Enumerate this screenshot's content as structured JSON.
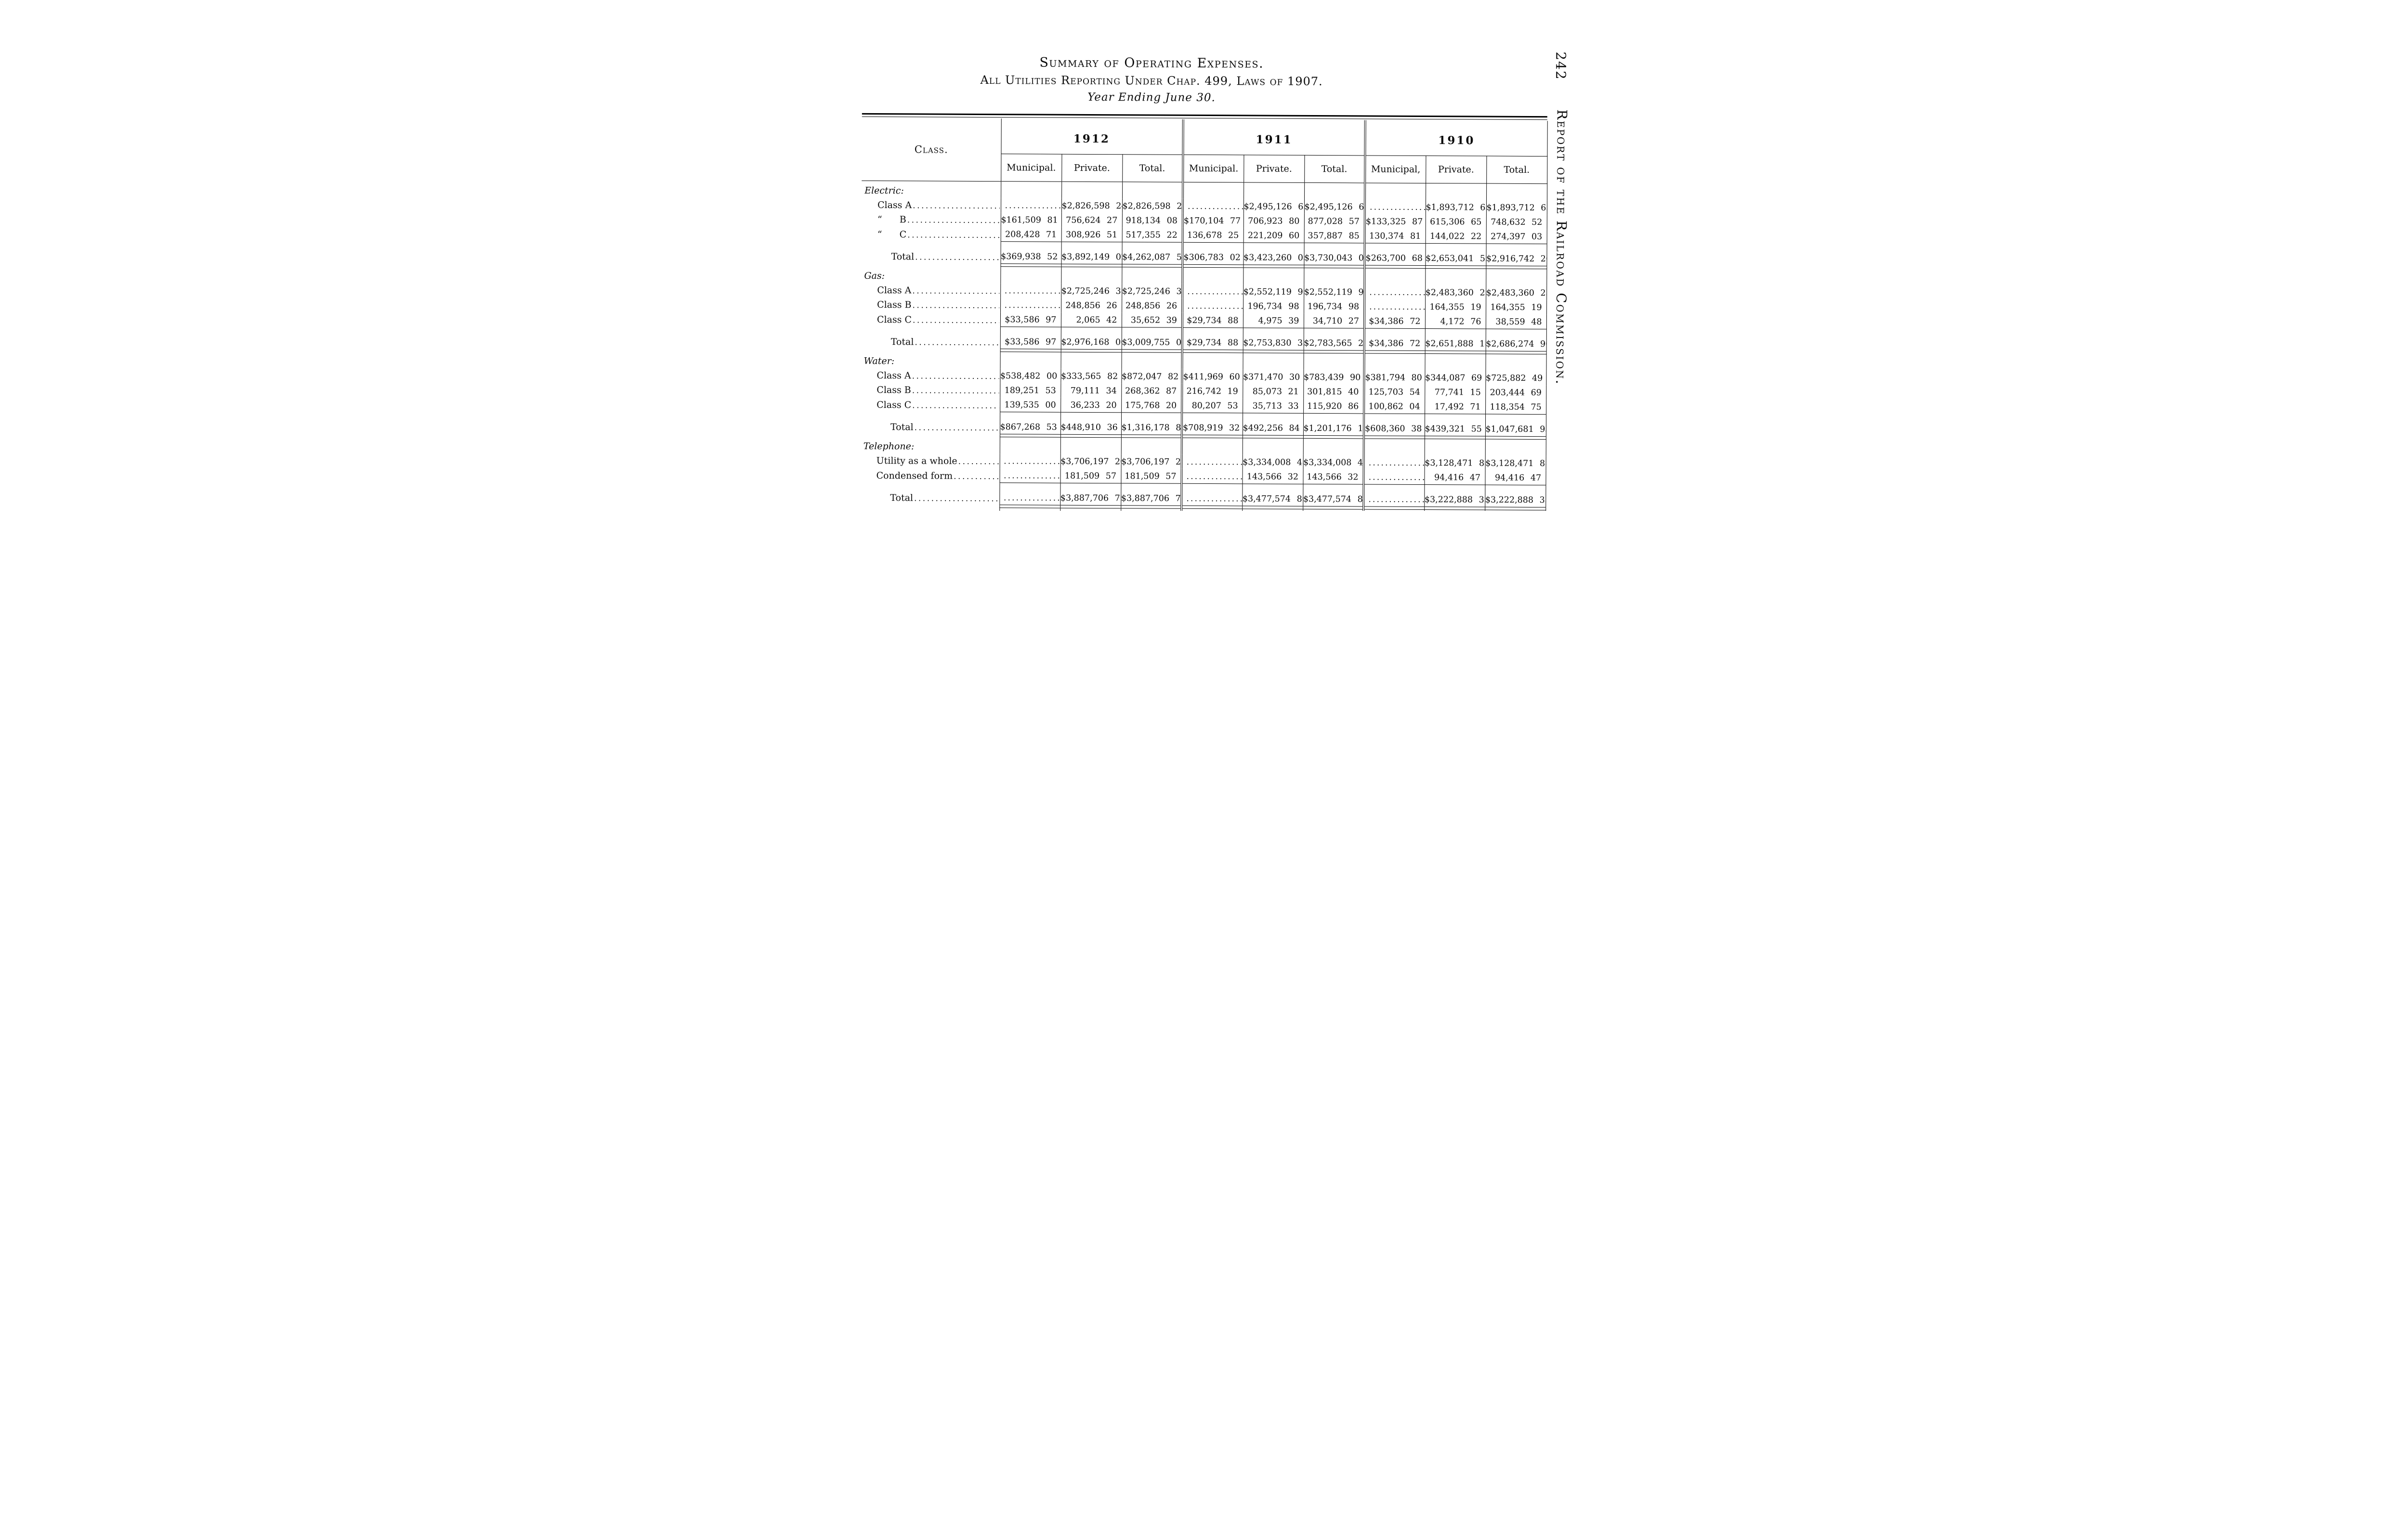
{
  "page": {
    "number": "242",
    "side_title": "Report of the Railroad Commission."
  },
  "title": {
    "line1": "Summary of Operating Expenses.",
    "line2": "All Utilities Reporting Under Chap. 499, Laws of 1907.",
    "line3": "Year Ending June 30."
  },
  "table": {
    "class_header": "Class.",
    "years": [
      {
        "label": "1912",
        "columns": [
          "Municipal.",
          "Private.",
          "Total."
        ]
      },
      {
        "label": "1911",
        "columns": [
          "Municipal.",
          "Private.",
          "Total."
        ]
      },
      {
        "label": "1910",
        "columns": [
          "Municipal,",
          "Private.",
          "Total."
        ]
      }
    ],
    "rows": [
      {
        "kind": "section",
        "em": "Electric:",
        "text": "",
        "indent": 0,
        "leader": false,
        "cells": [
          "",
          "",
          "",
          "",
          "",
          "",
          "",
          "",
          ""
        ]
      },
      {
        "kind": "item",
        "em": "",
        "text": "Class A",
        "indent": 1,
        "leader": true,
        "cells": [
          "..............",
          "$2,826,598 24",
          "$2,826,598 24",
          "..............",
          "$2,495,126 65",
          "$2,495,126 65",
          "..............",
          "$1,893,712 65",
          "$1,893,712 65"
        ]
      },
      {
        "kind": "item",
        "em": "",
        "text": "“      B",
        "indent": 1,
        "leader": true,
        "cells": [
          "$161,509 81",
          "756,624 27",
          "918,134 08",
          "$170,104 77",
          "706,923 80",
          "877,028 57",
          "$133,325 87",
          "615,306 65",
          "748,632 52"
        ]
      },
      {
        "kind": "item",
        "em": "",
        "text": "“      C",
        "indent": 1,
        "leader": true,
        "cells": [
          "208,428 71",
          "308,926 51",
          "517,355 22",
          "136,678 25",
          "221,209 60",
          "357,887 85",
          "130,374 81",
          "144,022 22",
          "274,397 03"
        ]
      },
      {
        "kind": "total",
        "em": "",
        "text": "Total",
        "indent": 2,
        "leader": true,
        "cells": [
          "$369,938 52",
          "$3,892,149 02",
          "$4,262,087 54",
          "$306,783 02",
          "$3,423,260 05",
          "$3,730,043 07",
          "$263,700 68",
          "$2,653,041 52",
          "$2,916,742 20"
        ]
      },
      {
        "kind": "section",
        "em": "Gas:",
        "text": "",
        "indent": 0,
        "leader": false,
        "cells": [
          "",
          "",
          "",
          "",
          "",
          "",
          "",
          "",
          ""
        ]
      },
      {
        "kind": "item",
        "em": "",
        "text": "Class A",
        "indent": 1,
        "leader": true,
        "cells": [
          "..............",
          "$2,725,246 38",
          "$2,725,246 38",
          "..............",
          "$2,552,119 95",
          "$2,552,119 95",
          "..............",
          "$2,483,360 23",
          "$2,483,360 23"
        ]
      },
      {
        "kind": "item",
        "em": "",
        "text": "Class B",
        "indent": 1,
        "leader": true,
        "cells": [
          "..............",
          "248,856 26",
          "248,856 26",
          "..............",
          "196,734 98",
          "196,734 98",
          "..............",
          "164,355 19",
          "164,355 19"
        ]
      },
      {
        "kind": "item",
        "em": "",
        "text": "Class C",
        "indent": 1,
        "leader": true,
        "cells": [
          "$33,586 97",
          "2,065 42",
          "35,652 39",
          "$29,734 88",
          "4,975 39",
          "34,710 27",
          "$34,386 72",
          "4,172 76",
          "38,559 48"
        ]
      },
      {
        "kind": "total",
        "em": "",
        "text": "Total",
        "indent": 2,
        "leader": true,
        "cells": [
          "$33,586 97",
          "$2,976,168 06",
          "$3,009,755 03",
          "$29,734 88",
          "$2,753,830 32",
          "$2,783,565 20",
          "$34,386 72",
          "$2,651,888 18",
          "$2,686,274 90"
        ]
      },
      {
        "kind": "section",
        "em": "Water:",
        "text": "",
        "indent": 0,
        "leader": false,
        "cells": [
          "",
          "",
          "",
          "",
          "",
          "",
          "",
          "",
          ""
        ]
      },
      {
        "kind": "item",
        "em": "",
        "text": "Class A",
        "indent": 1,
        "leader": true,
        "cells": [
          "$538,482 00",
          "$333,565 82",
          "$872,047 82",
          "$411,969 60",
          "$371,470 30",
          "$783,439 90",
          "$381,794 80",
          "$344,087 69",
          "$725,882 49"
        ]
      },
      {
        "kind": "item",
        "em": "",
        "text": "Class B",
        "indent": 1,
        "leader": true,
        "cells": [
          "189,251 53",
          "79,111 34",
          "268,362 87",
          "216,742 19",
          "85,073 21",
          "301,815 40",
          "125,703 54",
          "77,741 15",
          "203,444 69"
        ]
      },
      {
        "kind": "item",
        "em": "",
        "text": "Class C",
        "indent": 1,
        "leader": true,
        "cells": [
          "139,535 00",
          "36,233 20",
          "175,768 20",
          "80,207 53",
          "35,713 33",
          "115,920 86",
          "100,862 04",
          "17,492 71",
          "118,354 75"
        ]
      },
      {
        "kind": "total",
        "em": "",
        "text": "Total",
        "indent": 2,
        "leader": true,
        "cells": [
          "$867,268 53",
          "$448,910 36",
          "$1,316,178 89",
          "$708,919 32",
          "$492,256 84",
          "$1,201,176 16",
          "$608,360 38",
          "$439,321 55",
          "$1,047,681 93"
        ]
      },
      {
        "kind": "section",
        "em": "Telephone:",
        "text": "",
        "indent": 0,
        "leader": false,
        "cells": [
          "",
          "",
          "",
          "",
          "",
          "",
          "",
          "",
          ""
        ]
      },
      {
        "kind": "item",
        "em": "",
        "text": "Utility as a whole",
        "indent": 1,
        "leader": true,
        "cells": [
          "..............",
          "$3,706,197 20",
          "$3,706,197 20",
          "..............",
          "$3,334,008 48",
          "$3,334,008 48",
          "..............",
          "$3,128,471 88",
          "$3,128,471 88"
        ]
      },
      {
        "kind": "item",
        "em": "",
        "text": "Condensed form",
        "indent": 1,
        "leader": true,
        "cells": [
          "..............",
          "181,509 57",
          "181,509 57",
          "..............",
          "143,566 32",
          "143,566 32",
          "..............",
          "94,416 47",
          "94,416 47"
        ]
      },
      {
        "kind": "total",
        "em": "",
        "text": "Total",
        "indent": 2,
        "leader": true,
        "cells": [
          "..............",
          "$3,887,706 77",
          "$3,887,706 77",
          "..............",
          "$3,477,574 80",
          "$3,477,574 80",
          "..............",
          "$3,222,888 35",
          "$3,222,888 35"
        ]
      },
      {
        "kind": "single",
        "em": "Heating:",
        "text": "   Total",
        "indent": 0,
        "leader": true,
        "cells": [
          "$2,575 33",
          "$266,099 61",
          "$268,674 94",
          "$760 04",
          "$194,445 65",
          "$195,205 69",
          "$573 56",
          "$185,061 89",
          "$185,635 45"
        ]
      },
      {
        "kind": "grand",
        "em": "",
        "text": "Total all utilities",
        "indent": 1,
        "leader": true,
        "cells": [
          "$1,273,369 35",
          "$11,471,033 82",
          "$12,744,403 17",
          "$1,046,197 26",
          "$10,341,367 66",
          "$11,387,564 92",
          "$907,021 34",
          "$9,152,201 49",
          "$10,059,222 83"
        ]
      }
    ]
  }
}
